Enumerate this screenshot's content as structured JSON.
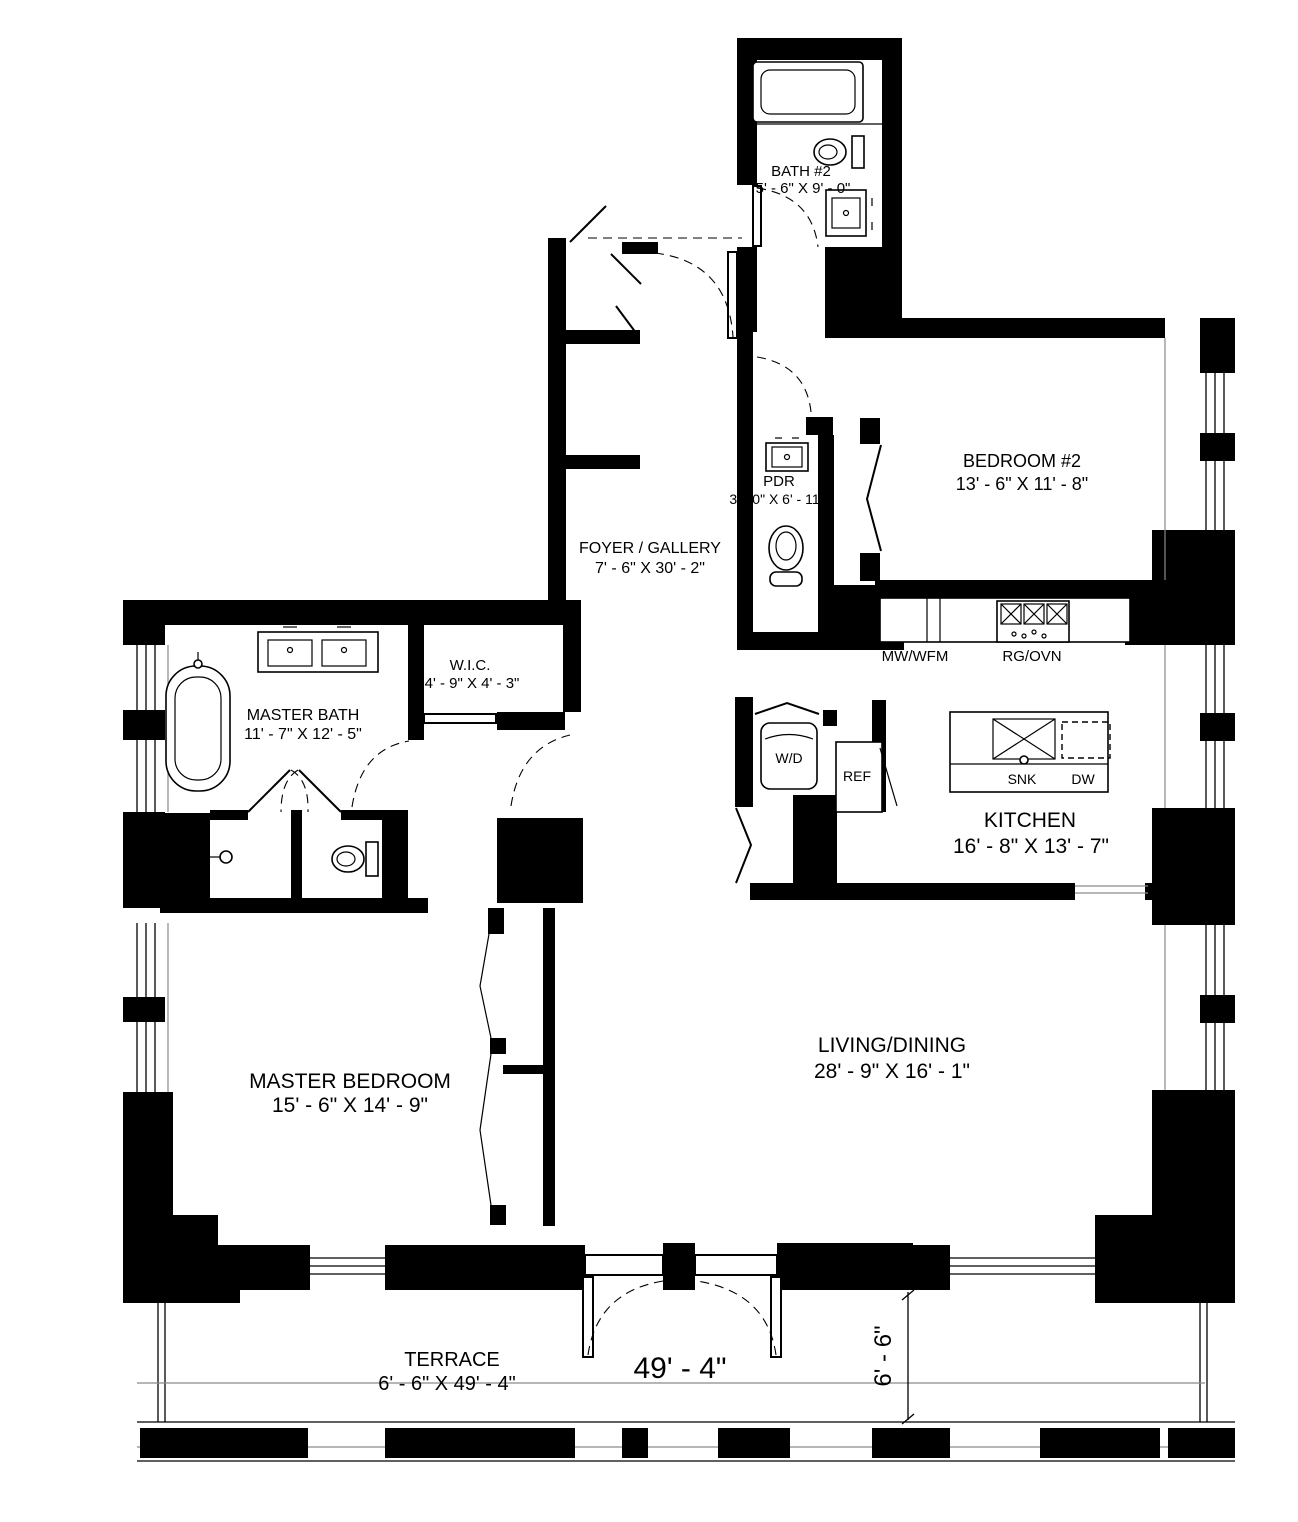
{
  "plan_title": "Two-bedroom floor plan",
  "colors": {
    "wall": "#000000",
    "line": "#1a1a1a",
    "muted": "#8a8a8a",
    "background": "#ffffff"
  },
  "rooms": {
    "bath2": {
      "name": "BATH #2",
      "dims": "5' - 6\" X  9' - 0\""
    },
    "bedroom2": {
      "name": "BEDROOM #2",
      "dims": "13' - 6\" X  11' - 8\""
    },
    "pdr": {
      "name": "PDR",
      "dims": "3' - 0\" X  6' - 11\""
    },
    "foyer": {
      "name": "FOYER / GALLERY",
      "dims": "7' - 6\" X  30' - 2\""
    },
    "wic": {
      "name": "W.I.C.",
      "dims": "4' - 9\" X  4' - 3\""
    },
    "master_bath": {
      "name": "MASTER BATH",
      "dims": "11' - 7\" X  12' - 5\""
    },
    "kitchen": {
      "name": "KITCHEN",
      "dims": "16' - 8\" X  13' - 7\""
    },
    "master_bedroom": {
      "name": "MASTER BEDROOM",
      "dims": "15' - 6\" X  14' - 9\""
    },
    "living_dining": {
      "name": "LIVING/DINING",
      "dims": "28' - 9\" X  16' - 1\""
    },
    "terrace": {
      "name": "TERRACE",
      "dims": "6' - 6\" X 49' - 4\""
    }
  },
  "labels": {
    "mw_wfm": "MW/WFM",
    "rg_ovn": "RG/OVN",
    "wd": "W/D",
    "ref": "REF",
    "snk": "SNK",
    "dw": "DW"
  },
  "dimensions": {
    "terrace_length": "49' - 4\"",
    "terrace_depth": "6' - 6\""
  }
}
